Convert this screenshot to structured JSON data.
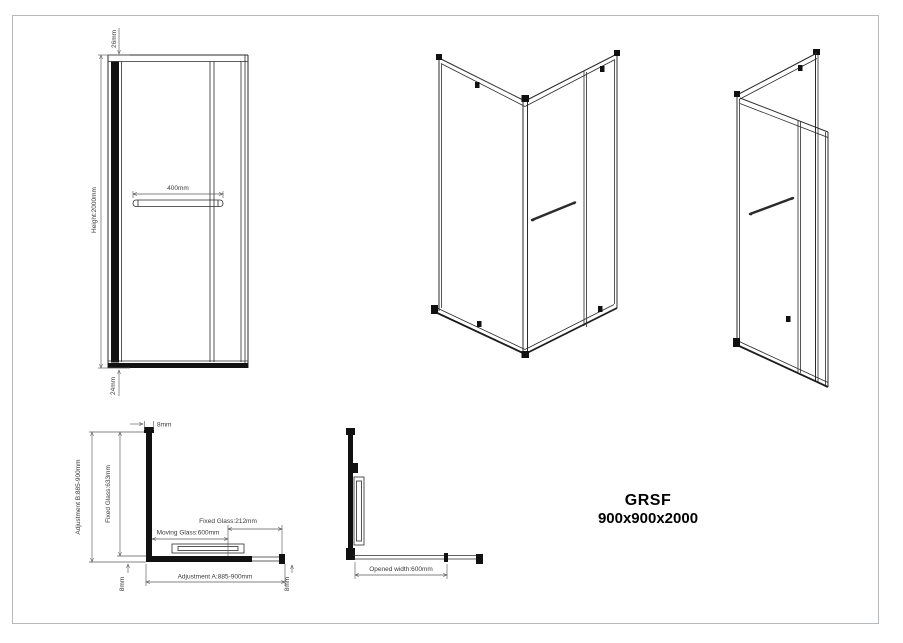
{
  "title_block": {
    "model": "GRSF",
    "size": "900x900x2000"
  },
  "front_view": {
    "height_label": "Height:2000mm",
    "top_offset_label": "26mm",
    "bottom_offset_label": "24mm",
    "handle_width_label": "400mm"
  },
  "plan_view_closed": {
    "adjustment_b_label": "Adjustment B:885-900mm",
    "fixed_glass_b_label": "Fixed Glass:633mm",
    "top_thickness_label": "8mm",
    "fixed_glass_a_label": "Fixed Glass:212mm",
    "moving_glass_label": "Moving Glass:600mm",
    "adjustment_a_label": "Adjustment A:885-900mm",
    "left_thickness_label": "8mm",
    "right_thickness_label": "8mm"
  },
  "plan_view_open": {
    "opened_width_label": "Opened width:600mm"
  },
  "colors": {
    "line": "#2b2b2b",
    "dimension": "#5a5a5a",
    "sheet_border": "#b6babc",
    "background": "#ffffff"
  }
}
